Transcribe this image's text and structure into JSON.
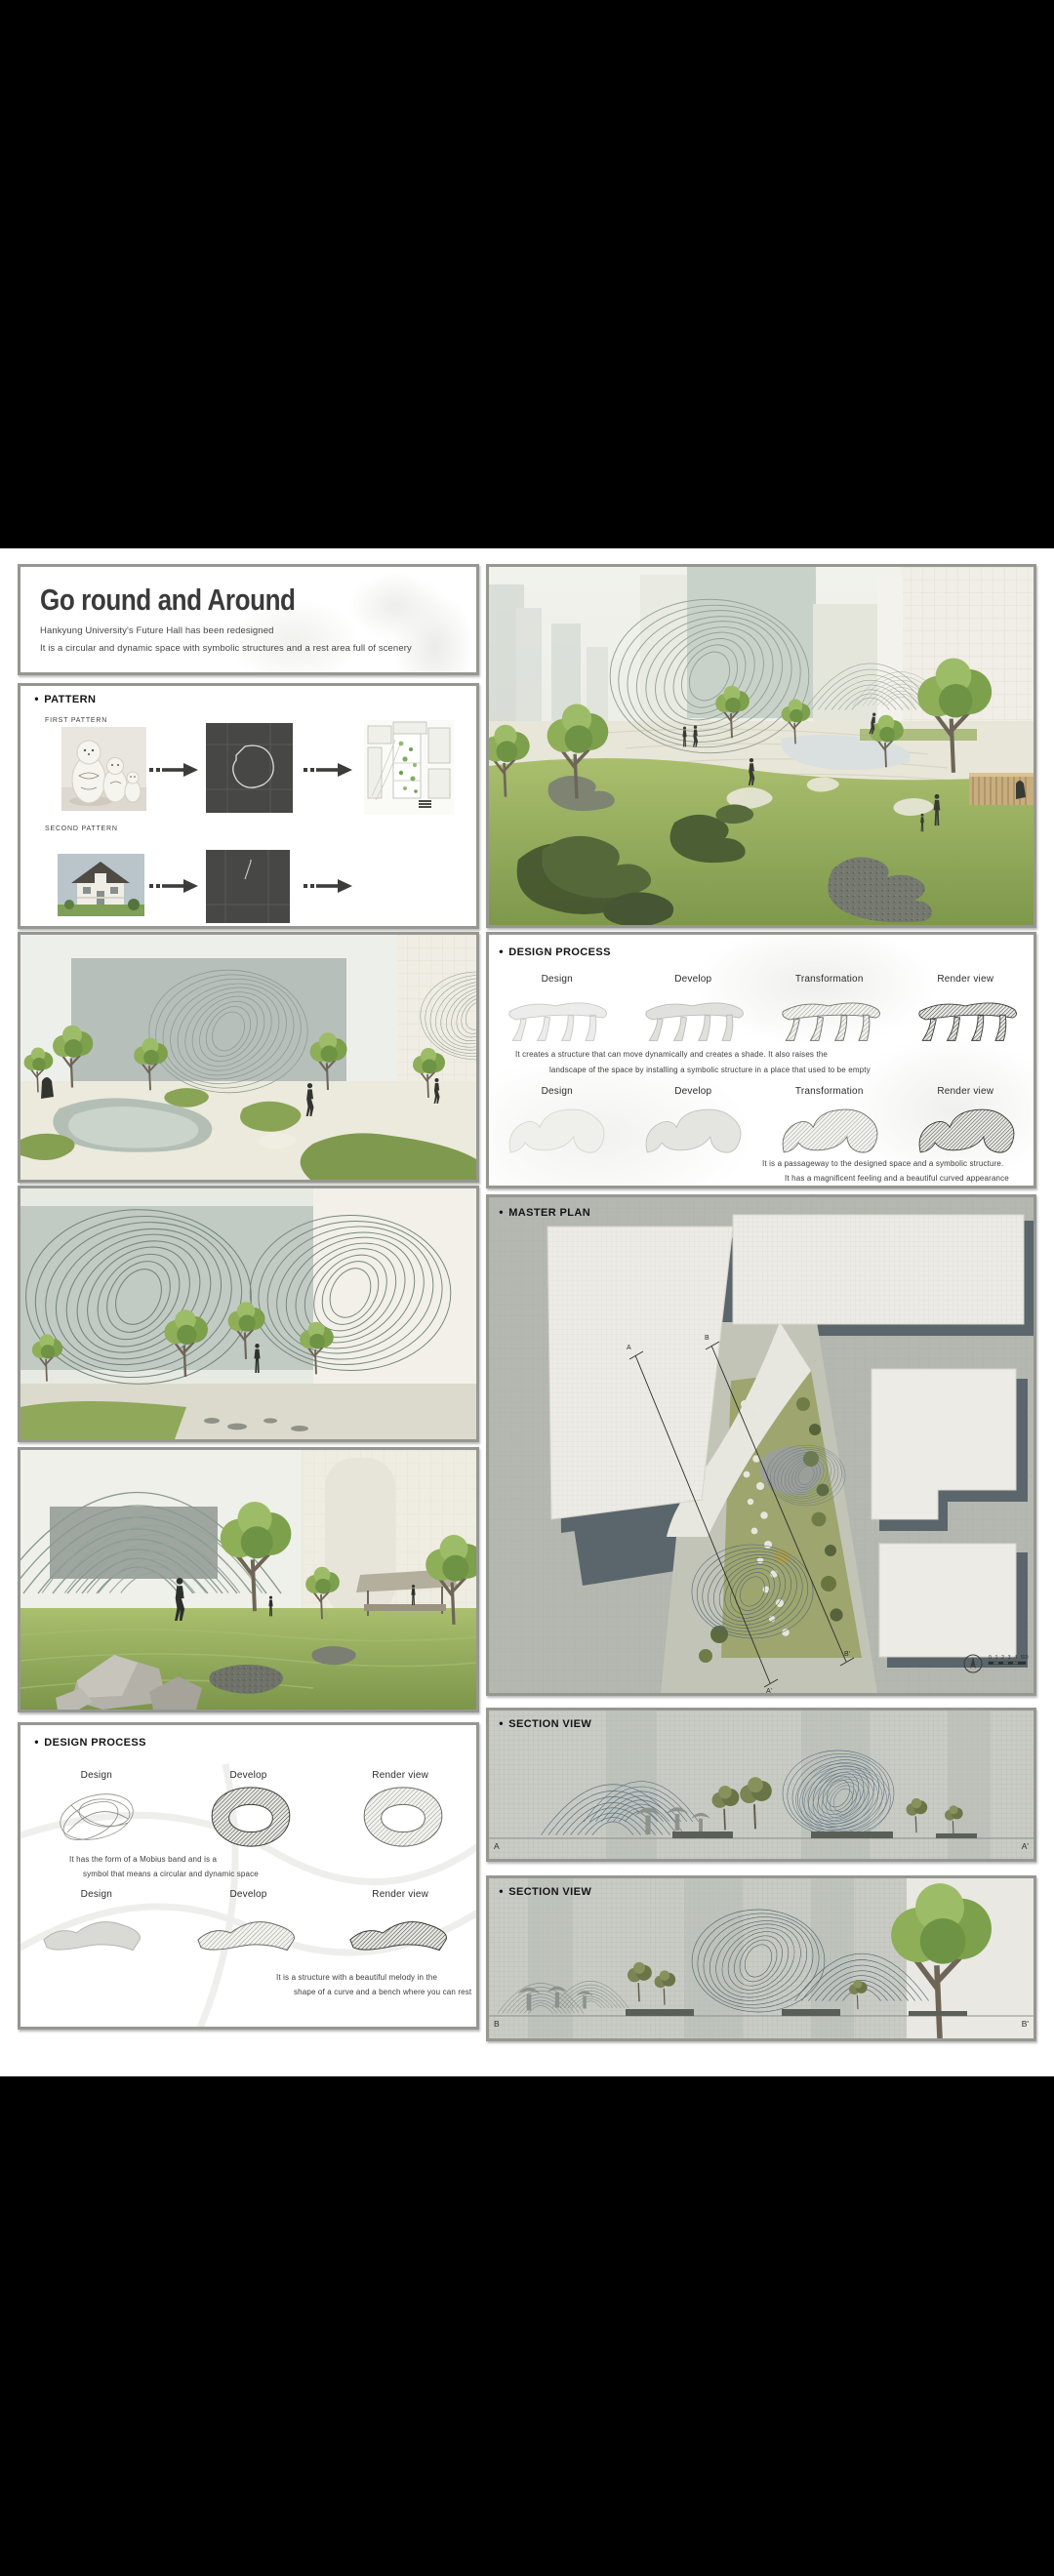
{
  "page": {
    "bullet": "●"
  },
  "title_panel": {
    "title": "Go round and Around",
    "subtitle1": "Hankyung University's Future Hall has been redesigned",
    "subtitle2": "It is a circular and dynamic space with symbolic structures and a rest area full of scenery"
  },
  "pattern": {
    "header": "PATTERN",
    "first_label": "FIRST PATTERN",
    "second_label": "SECOND PATTERN"
  },
  "design_process_right": {
    "header": "DESIGN PROCESS",
    "row1_labels": [
      "Design",
      "Develop",
      "Transformation",
      "Render view"
    ],
    "row1_caption": [
      "It creates a structure that can move dynamically and creates a shade. It also raises the",
      "landscape of the space by installing a symbolic structure in a place that used to be empty"
    ],
    "row2_labels": [
      "Design",
      "Develop",
      "Transformation",
      "Render view"
    ],
    "row2_caption": [
      "It is a passageway to the designed space and a symbolic structure.",
      "It has a magnificent feeling and a beautiful curved appearance"
    ]
  },
  "master_plan": {
    "header": "MASTER PLAN",
    "cut_marks": [
      "A",
      "A'",
      "B",
      "B'"
    ],
    "scale_numbers": "0 1 2 3 4 5",
    "scale_end": "10"
  },
  "section_view_1": {
    "header": "SECTION VIEW",
    "mark_left": "A",
    "mark_right": "A'"
  },
  "section_view_2": {
    "header": "SECTION VIEW",
    "mark_left": "B",
    "mark_right": "B'"
  },
  "design_process_left": {
    "header": "DESIGN PROCESS",
    "rowA_labels": [
      "Design",
      "Develop",
      "Render view"
    ],
    "rowA_caption": [
      "It has the form of a Mobius band and is a",
      "symbol that means a circular and dynamic space"
    ],
    "rowB_labels": [
      "Design",
      "Develop",
      "Render view"
    ],
    "rowB_caption": [
      "It is a structure with a beautiful melody in the",
      "shape of a curve and a bench where you can rest"
    ]
  }
}
